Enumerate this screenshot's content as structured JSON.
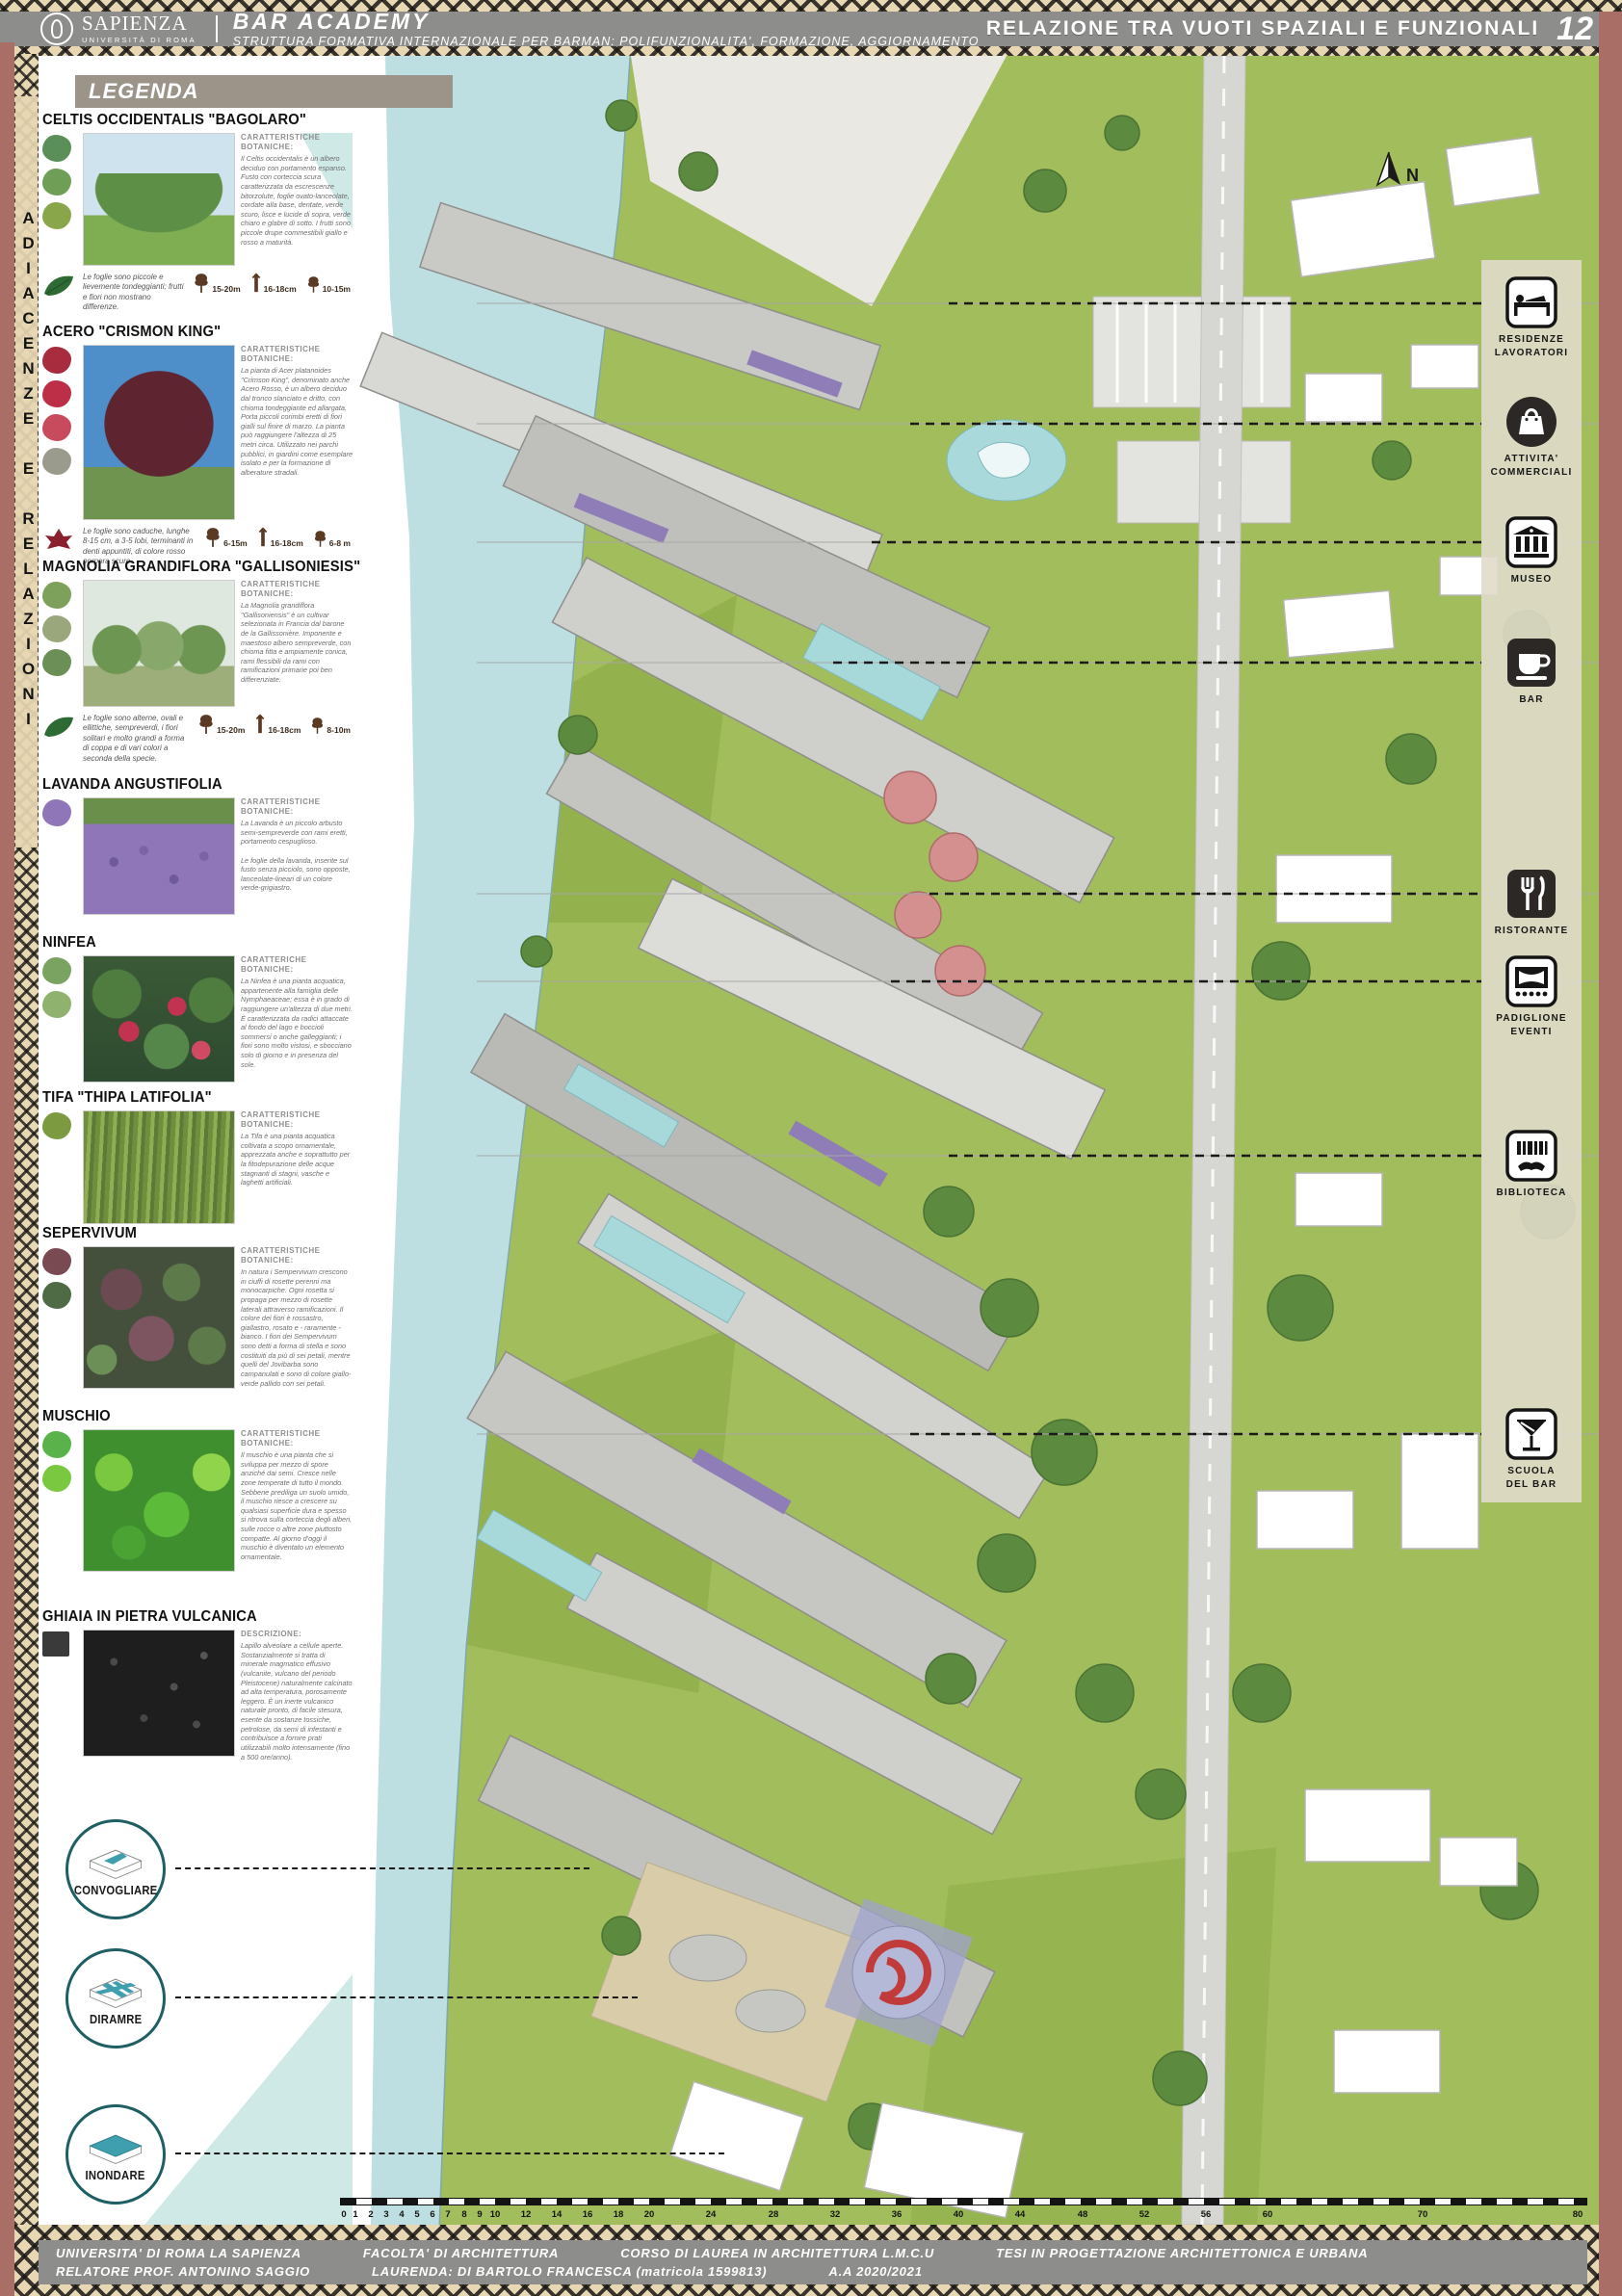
{
  "header": {
    "sapienza_title": "SAPIENZA",
    "sapienza_subtitle": "UNIVERSITÀ DI ROMA",
    "project_title": "BAR ACADEMY",
    "project_subtitle": "STRUTTURA FORMATIVA INTERNAZIONALE PER BARMAN: POLIFUNZIONALITA', FORMAZIONE, AGGIORNAMENTO",
    "board_title": "RELAZIONE TRA VUOTI SPAZIALI E FUNZIONALI",
    "board_number": "12"
  },
  "side_strip": {
    "text": "ADIACENZE E RELAZIONI"
  },
  "legend": {
    "title": "LEGENDA",
    "entries": [
      {
        "name": "CELTIS OCCIDENTALIS \"BAGOLARO\"",
        "section_label": "CARATTERISTICHE BOTANICHE:",
        "description": "Il Celtis occidentalis è un albero deciduo con portamento espanso. Fusto con corteccia scura caratterizzata da escrescenze bitorzolute, foglie ovato-lanceolate, cordate alla base, dentate, verde scuro, lisce e lucide di sopra, verde chiaro e glabre di sotto. I frutti sono piccole drupe commestibili giallo e rosso a maturità.",
        "note": "Le foglie sono piccole e lievemente tondeggianti; frutti e fiori non mostrano differenze.",
        "sizes": [
          "15-20m",
          "16-18cm",
          "10-15m"
        ]
      },
      {
        "name": "ACERO \"CRISMON KING\"",
        "section_label": "CARATTERISTICHE BOTANICHE:",
        "description": "La pianta di Acer platanoides \"Crimson King\", denominato anche Acero Rosso, è un albero deciduo dal tronco slanciato e dritto, con chioma tondeggiante ed allargata. Porta piccoli corimbi eretti di fiori gialli sul finire di marzo. La pianta può raggiungere l'altezza di 25 metri circa. Utilizzato nei parchi pubblici, in giardini come esemplare isolato e per la formazione di alberature stradali.",
        "note": "Le foglie sono caduche, lunghe 8-15 cm, a 3-5 lobi, terminanti in denti appuntiti, di colore rosso porpora scuro.",
        "sizes": [
          "6-15m",
          "16-18cm",
          "6-8 m"
        ]
      },
      {
        "name": "MAGNOLIA GRANDIFLORA \"GALLISONIESIS\"",
        "section_label": "CARATTERISTICHE BOTANICHE:",
        "description": "La Magnolia grandiflora \"Gallisoniensis\" è un cultivar selezionata in Francia dal barone de la Gallissonière. Imponente e maestoso albero sempreverde, con chioma fitta e ampiamente conica, rami flessibili da rami con ramificazioni primarie poi ben differenziate.",
        "note": "Le foglie sono alterne, ovali e ellittiche, sempreverdi, i fiori solitari e molto grandi a forma di coppa e di vari colori a seconda della specie.",
        "sizes": [
          "15-20m",
          "16-18cm",
          "8-10m"
        ]
      },
      {
        "name": "LAVANDA ANGUSTIFOLIA",
        "section_label": "CARATTERISTICHE BOTANICHE:",
        "description": "La Lavanda è un piccolo arbusto semi-sempreverde con rami eretti, portamento cespuglioso.\n\nLe foglie della lavanda, inserite sul fusto senza picciolo, sono opposte, lanceolate-lineari di un colore verde-grigiastro."
      },
      {
        "name": "NINFEA",
        "section_label": "CARATTERICHE BOTANICHE:",
        "description": "La Ninfea è una pianta acquatica, appartenente alla famiglia delle Nymphaeaceae; essa è in grado di raggiungere un'altezza di due metri. È caratterizzata da radici attaccate al fondo del lago e boccioli sommersi o anche galleggianti; i fiori sono molto vistosi, e sbocciano solo di giorno e in presenza del sole."
      },
      {
        "name": "TIFA \"THIPA LATIFOLIA\"",
        "section_label": "CARATTERISTICHE BOTANICHE:",
        "description": "La Tifa è una pianta acquatica coltivata a scopo ornamentale, apprezzata anche e soprattutto per la fitodepurazione delle acque stagnanti di stagni, vasche e laghetti artificiali."
      },
      {
        "name": "SEPERVIVUM",
        "section_label": "CARATTERISTICHE BOTANICHE:",
        "description": "In natura i Sempervivum crescono in ciuffi di rosette perenni ma monocarpiche. Ogni rosetta si propaga per mezzo di rosette laterali attraverso ramificazioni. Il colore dei fiori è rossastro, giallastro, rosato e - raramente - bianco. I fiori dei Sempervivum sono detti a forma di stella e sono costituiti da più di sei petali, mentre quelli del Jovibarba sono campanulati e sono di colore giallo-verde pallido con sei petali."
      },
      {
        "name": "MUSCHIO",
        "section_label": "CARATTERISTICHE BOTANICHE:",
        "description": "Il muschio è una pianta che si sviluppa per mezzo di spore anziché dai semi. Cresce nelle zone temperate di tutto il mondo. Sebbene prediliga un suolo umido, il muschio riesce a crescere su qualsiasi superficie dura e spesso si ritrova sulla corteccia degli alberi, sulle rocce o altre zone piuttosto compatte. Al giorno d'oggi il muschio è diventato un elemento ornamentale.",
        "note": ""
      },
      {
        "name": "GHIAIA IN PIETRA VULCANICA",
        "section_label": "DESCRIZIONE:",
        "description": "Lapillo alveolare a cellule aperte. Sostanzialmente si tratta di minerale magmatico effusivo (vulcanite, vulcano del periodo Pleistocene) naturalmente calcinato ad alta temperatura, porosamente leggero. È un inerte vulcanico naturale pronto, di facile stesura, esente da sostanze tossiche, petrolose, da semi di infestanti e contribuisce a fornire prati utilizzabili molto intensamente (fino a 500 ore/anno)."
      }
    ]
  },
  "strategies": [
    {
      "label": "CONVOGLIARE"
    },
    {
      "label": "DIRAMRE"
    },
    {
      "label": "INONDARE"
    }
  ],
  "functions": [
    {
      "icon": "bed-icon",
      "label": "RESIDENZE\nLAVORATORI"
    },
    {
      "icon": "shopping-bag-icon",
      "label": "ATTIVITA'\nCOMMERCIALI"
    },
    {
      "icon": "museum-icon",
      "label": "MUSEO"
    },
    {
      "icon": "coffee-cup-icon",
      "label": "BAR"
    },
    {
      "icon": "fork-knife-icon",
      "label": "RISTORANTE"
    },
    {
      "icon": "stage-icon",
      "label": "PADIGLIONE\nEVENTI"
    },
    {
      "icon": "books-icon",
      "label": "BIBLIOTECA"
    },
    {
      "icon": "martini-icon",
      "label": "SCUOLA\nDEL BAR"
    }
  ],
  "map": {
    "north_label": "N"
  },
  "scale": {
    "values": [
      "0",
      "1",
      "2",
      "3",
      "4",
      "5",
      "6",
      "7",
      "8",
      "9",
      "10",
      "12",
      "14",
      "16",
      "18",
      "20",
      "24",
      "28",
      "32",
      "36",
      "40",
      "44",
      "48",
      "52",
      "56",
      "60",
      "70",
      "80"
    ]
  },
  "footer": {
    "line1": [
      "UNIVERSITA' DI ROMA LA SAPIENZA",
      "FACOLTA' DI ARCHITETTURA",
      "CORSO DI LAUREA IN ARCHITETTURA L.M.C.U",
      "TESI IN PROGETTAZIONE ARCHITETTONICA E URBANA"
    ],
    "line2": [
      "RELATORE PROF. ANTONINO SAGGIO",
      "LAURENDA: DI BARTOLO FRANCESCA (matricola 1599813)",
      "A.A 2020/2021"
    ]
  },
  "colors": {
    "accent_red": "#a96e66",
    "pattern_tan": "#e7d7b3",
    "header_gray": "#8d8d8b",
    "river_blue": "#bddfe1",
    "teal": "#3f9fae",
    "grass_green": "#a2bd5b"
  }
}
